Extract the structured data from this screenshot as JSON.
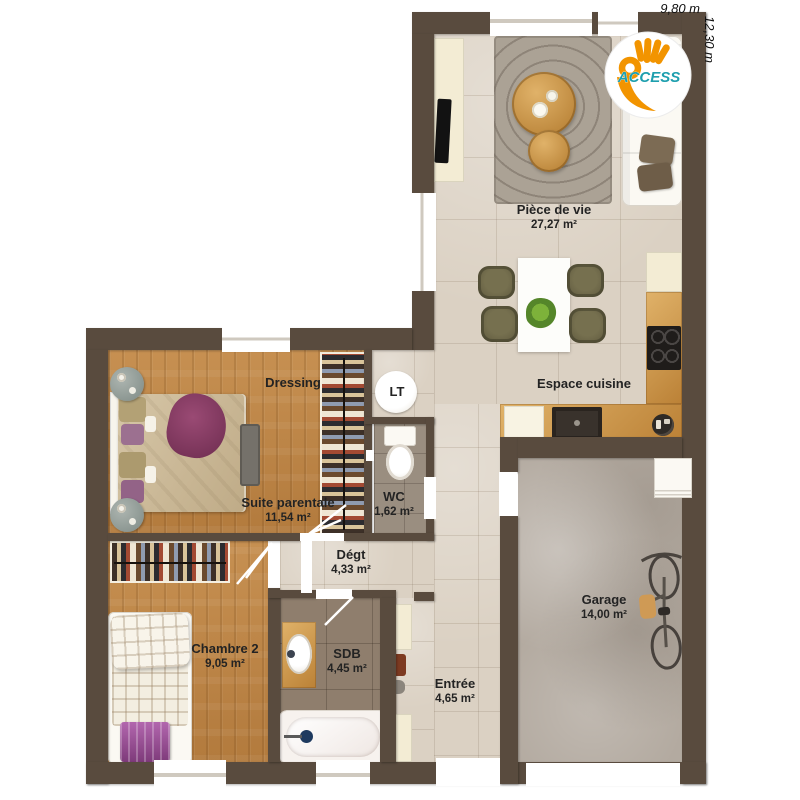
{
  "meta": {
    "type": "floor-plan"
  },
  "dimensions": {
    "width": "9,80 m",
    "height": "12,30 m"
  },
  "logo": {
    "brand": "ACCESS"
  },
  "rooms": [
    {
      "id": "piece-de-vie",
      "name": "Pièce de vie",
      "area": "27,27 m²"
    },
    {
      "id": "espace-cuisine",
      "name": "Espace cuisine",
      "area": ""
    },
    {
      "id": "dressing",
      "name": "Dressing",
      "area": ""
    },
    {
      "id": "lt",
      "name": "LT",
      "area": ""
    },
    {
      "id": "suite-parentale",
      "name": "Suite parentale",
      "area": "11,54 m²"
    },
    {
      "id": "wc",
      "name": "WC",
      "area": "1,62 m²"
    },
    {
      "id": "degt",
      "name": "Dégt",
      "area": "4,33 m²"
    },
    {
      "id": "chambre-2",
      "name": "Chambre 2",
      "area": "9,05 m²"
    },
    {
      "id": "sdb",
      "name": "SDB",
      "area": "4,45 m²"
    },
    {
      "id": "entree",
      "name": "Entrée",
      "area": "4,65 m²"
    },
    {
      "id": "garage",
      "name": "Garage",
      "area": "14,00 m²"
    }
  ],
  "colors": {
    "wall": "#594b3e",
    "tile": "#dbd1c3",
    "wood": "#c08544",
    "garage": "#b3aaa0",
    "sdb": "#8f7e6d",
    "wc": "#9a8e80",
    "cream": "#f3ecd4",
    "olive": "#76704f",
    "logo-orange": "#f29400",
    "logo-teal": "#1e9fae"
  }
}
